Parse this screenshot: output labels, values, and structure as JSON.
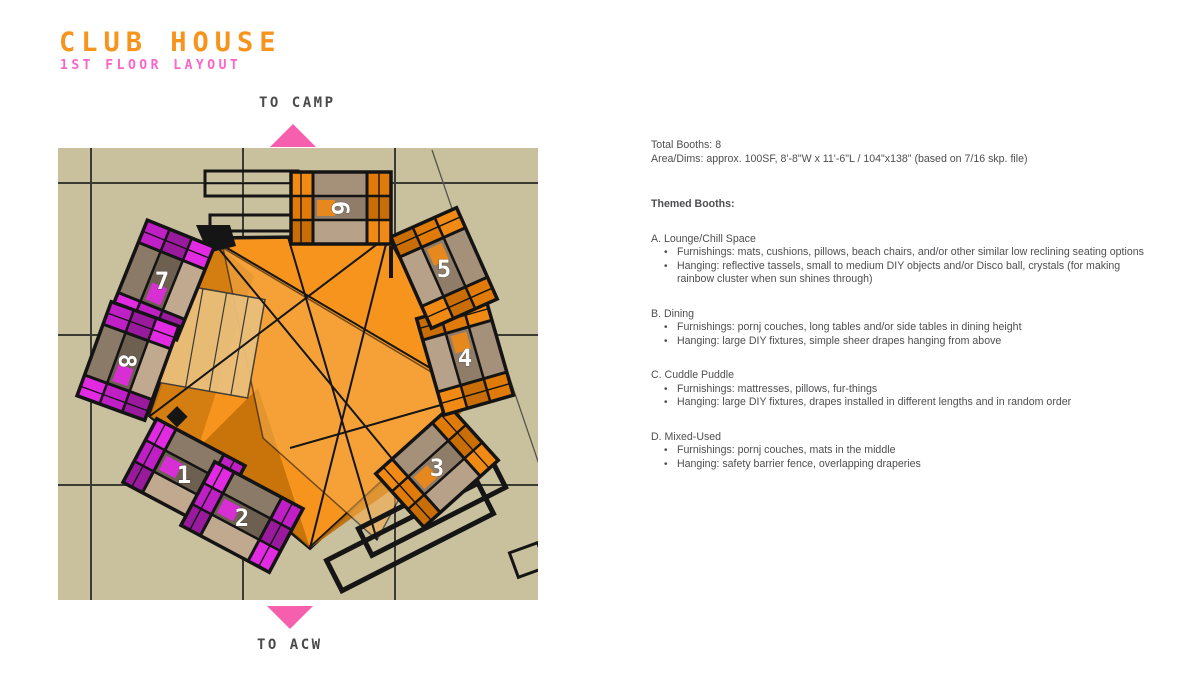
{
  "header": {
    "title": "CLUB HOUSE",
    "subtitle": "1ST FLOOR LAYOUT",
    "title_color": "#f7941d",
    "subtitle_color": "#fd63c8"
  },
  "plan": {
    "direction_top": "TO CAMP",
    "direction_bottom": "TO ACW",
    "arrow_color": "#f55fae",
    "floor_background": "#c9c09e",
    "canopy_color": "#f7941d",
    "outline_color": "#161616",
    "booths": [
      {
        "id": "1",
        "label": "1",
        "theme": "magenta"
      },
      {
        "id": "2",
        "label": "2",
        "theme": "magenta"
      },
      {
        "id": "3",
        "label": "3",
        "theme": "orange"
      },
      {
        "id": "4",
        "label": "4",
        "theme": "orange"
      },
      {
        "id": "5",
        "label": "5",
        "theme": "orange"
      },
      {
        "id": "6",
        "label": "6",
        "theme": "orange"
      },
      {
        "id": "7",
        "label": "7",
        "theme": "magenta"
      },
      {
        "id": "8",
        "label": "8",
        "theme": "magenta"
      }
    ],
    "palette": {
      "orange_cells": [
        "#f08a15",
        "#e07a08",
        "#c96d06"
      ],
      "orange_center": [
        "#a5907a",
        "#8f7d69",
        "#b7a189"
      ],
      "magenta_cells": [
        "#e32ae3",
        "#c01fc5",
        "#9a1a9e"
      ],
      "magenta_center": [
        "#8a7a67",
        "#6e6050",
        "#c0a98f"
      ]
    }
  },
  "notes": {
    "summary": [
      "Total Booths: 8",
      "Area/Dims: approx. 100SF, 8'-8\"W x 11'-6\"L / 104\"x138\" (based on 7/16 skp. file)"
    ],
    "themed_heading": "Themed Booths:",
    "sections": [
      {
        "label": "A. Lounge/Chill Space",
        "bullets": [
          "Furnishings: mats, cushions, pillows, beach chairs, and/or other similar low reclining seating options",
          "Hanging: reflective tassels, small to medium DIY objects and/or Disco ball, crystals (for making rainbow cluster when sun shines through)"
        ]
      },
      {
        "label": "B. Dining",
        "bullets": [
          "Furnishings: pornj couches, long tables and/or side tables in dining height",
          "Hanging: large DIY fixtures, simple sheer drapes hanging from above"
        ]
      },
      {
        "label": "C. Cuddle Puddle",
        "bullets": [
          "Furnishings: mattresses, pillows, fur-things",
          "Hanging: large DIY fixtures, drapes installed in different lengths and in random order"
        ]
      },
      {
        "label": "D. Mixed-Used",
        "bullets": [
          "Furnishings: pornj couches, mats in the middle",
          "Hanging: safety barrier fence, overlapping draperies"
        ]
      }
    ]
  }
}
